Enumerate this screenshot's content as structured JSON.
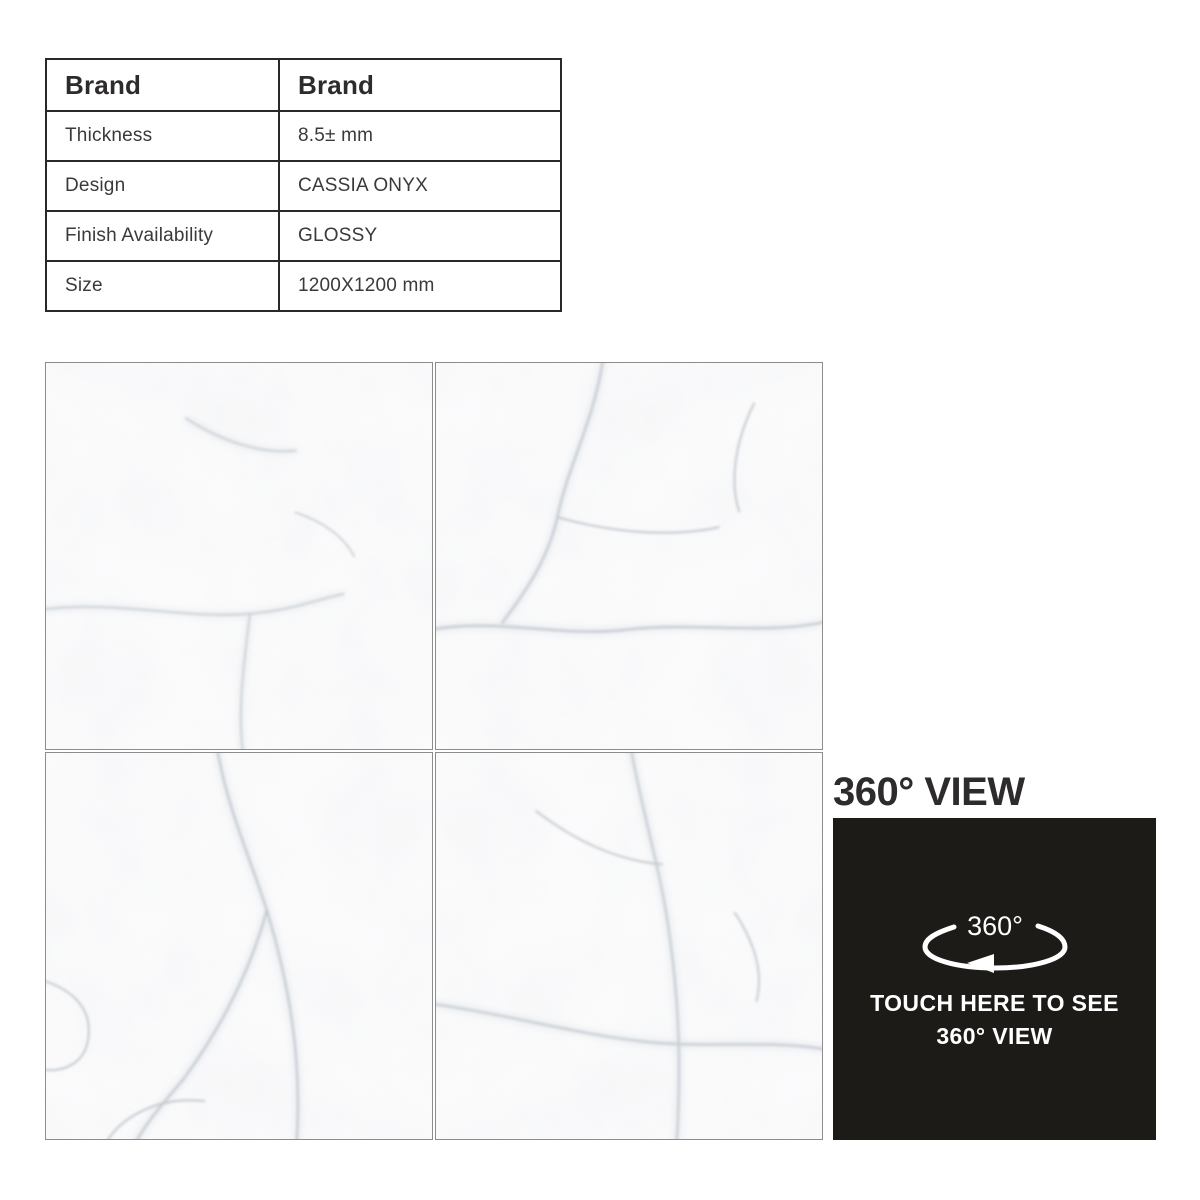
{
  "spec_table": {
    "header": {
      "label": "Brand",
      "value": "Brand"
    },
    "rows": [
      {
        "label": "Thickness",
        "value": "8.5± mm"
      },
      {
        "label": "Design",
        "value": "CASSIA ONYX"
      },
      {
        "label": "Finish Availability",
        "value": "GLOSSY"
      },
      {
        "label": "Size",
        "value": "1200X1200 mm"
      }
    ]
  },
  "view360": {
    "heading": "360° VIEW",
    "icon_label": "360°",
    "cta_line1": "TOUCH HERE TO SEE",
    "cta_line2": "360° VIEW"
  },
  "colors": {
    "panel_black": "#1c1b18",
    "heading_text": "#2e2b2c",
    "table_border": "#2b2829",
    "tile_border": "#8c8c8c",
    "marble_base": "#fbfbfc",
    "marble_vein": "#c4c9cf",
    "cta_text": "#ffffff"
  }
}
